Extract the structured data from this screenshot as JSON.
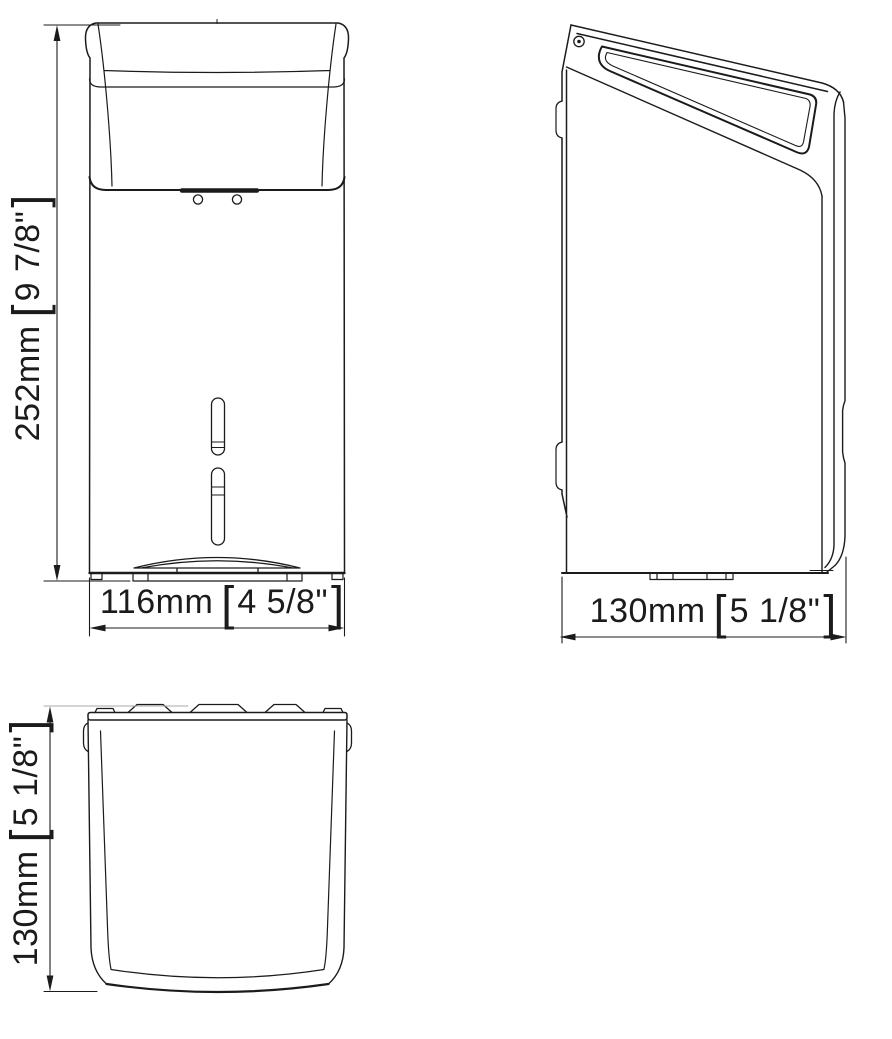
{
  "colors": {
    "line": "#1b1b1b",
    "dim_faint": "#a8a8a8",
    "background": "#ffffff"
  },
  "dimensions": {
    "front_height": {
      "metric": "252mm",
      "bracket_open": "[",
      "imperial": "9 7/8\"",
      "bracket_close": "]"
    },
    "front_width": {
      "metric": "116mm",
      "bracket_open": "[",
      "imperial": "4 5/8\"",
      "bracket_close": "]"
    },
    "side_depth": {
      "metric": "130mm",
      "bracket_open": "[",
      "imperial": "5 1/8\"",
      "bracket_close": "]"
    },
    "top_depth": {
      "metric": "130mm",
      "bracket_open": "[",
      "imperial": "5 1/8\"",
      "bracket_close": "]"
    }
  }
}
